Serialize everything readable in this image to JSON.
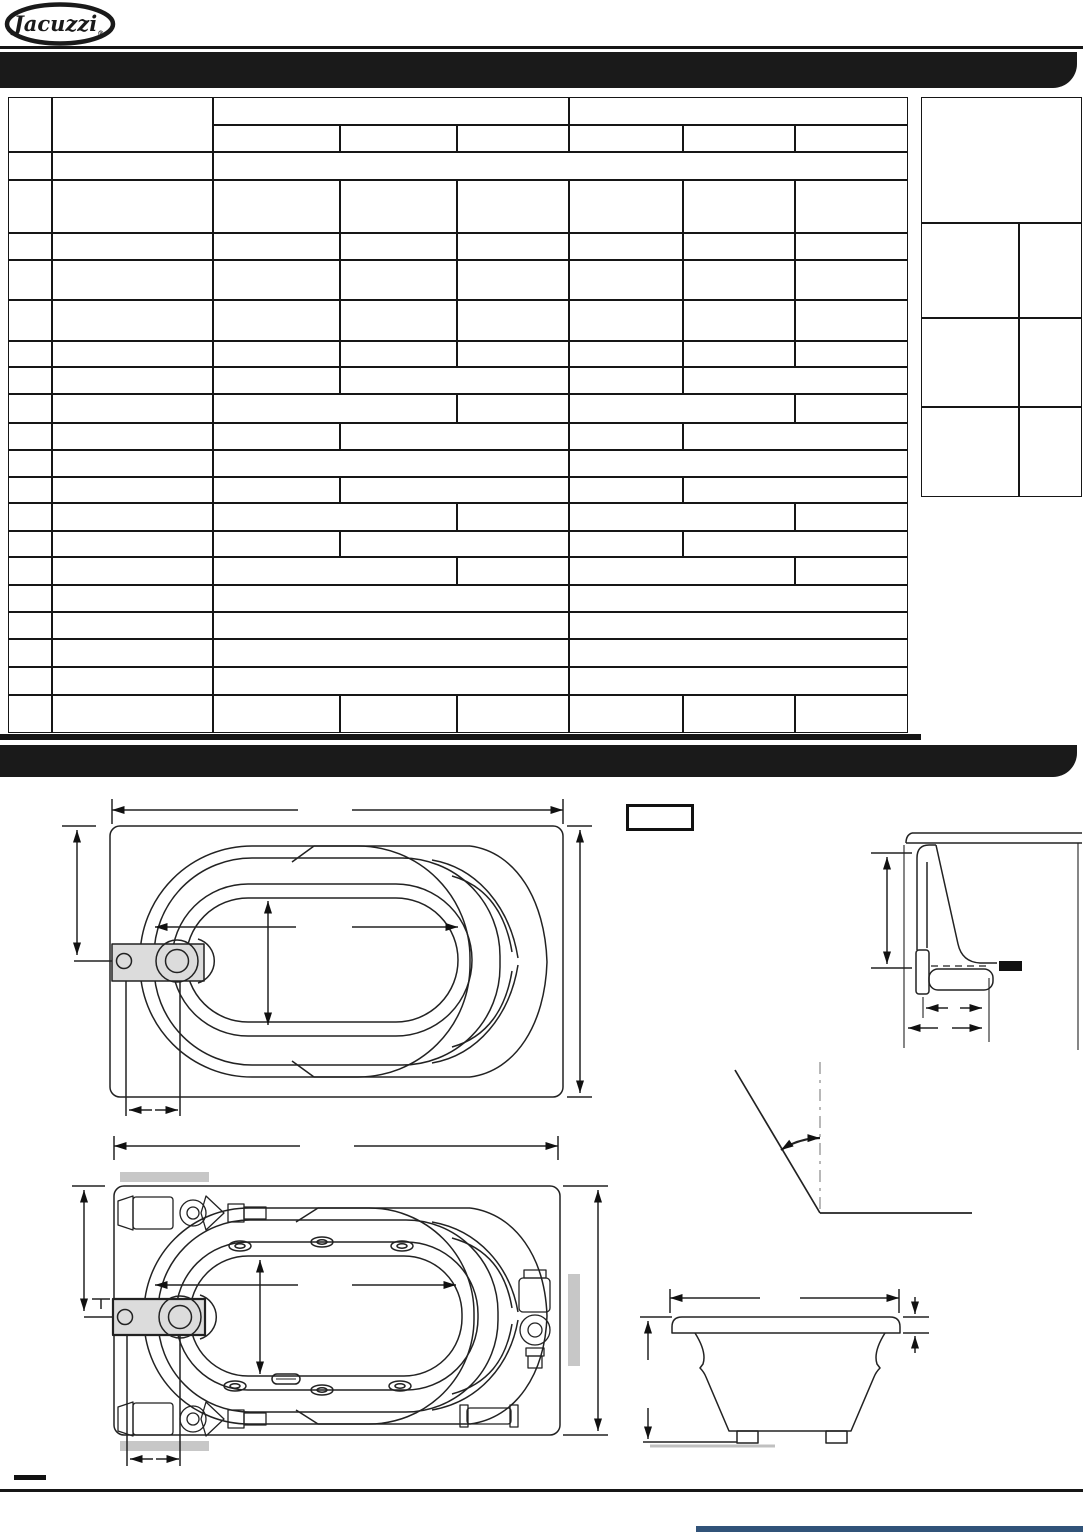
{
  "logo": {
    "brand": "Jacuzzi",
    "registered_mark": "®"
  },
  "header_banner": {
    "text": ""
  },
  "section_banner": {
    "text": ""
  },
  "spec_table": {
    "visible_text": ""
  },
  "colors": {
    "banner_black": "#1a1a1a",
    "table_line": "#161616",
    "pump_gray": "#dcdcdc",
    "gray_bar": "#c7c7c7",
    "footer_accent_blue": "#315379"
  }
}
